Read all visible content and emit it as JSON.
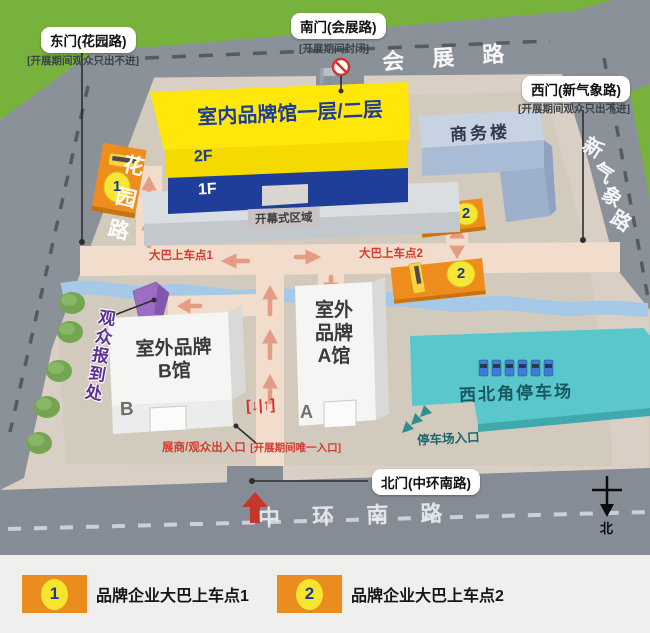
{
  "gates": {
    "east": {
      "label": "东门(花园路)",
      "note": "[开展期间观众只出不进]"
    },
    "south": {
      "label": "南门(会展路)",
      "note": "[开展期间封闭]"
    },
    "west": {
      "label": "西门(新气象路)",
      "note": "[开展期间观众只出不进]"
    },
    "north": {
      "label": "北门(中环南路)"
    }
  },
  "roads": {
    "top": "会 展 路",
    "left": "花园路",
    "right_chars": {
      "c1": "新",
      "c2": "气",
      "c3": "象",
      "c4": "路"
    },
    "bottom": "中 环 南 路"
  },
  "buildings": {
    "indoor_hall": {
      "title": "室内品牌馆一层/二层",
      "floor2": "2F",
      "floor1": "1F",
      "stage": "开幕式区域"
    },
    "business": "商务楼",
    "hall_b": {
      "line1": "室外品牌",
      "line2": "B馆",
      "letter": "B"
    },
    "hall_a": {
      "line1": "室外",
      "line2": "品牌",
      "line3": "A馆",
      "letter": "A"
    },
    "parking": {
      "name": "西北角停车场",
      "entrance": "停车场入口"
    },
    "reception": "观众报到处"
  },
  "paths": {
    "bus_stop1": "大巴上车点1",
    "bus_stop2": "大巴上车点2",
    "exit": "展商/观众出入口",
    "exit_note": "[开展期间唯一入口]",
    "gate_sign": "[↓|↑]"
  },
  "markers": {
    "stop1": "1",
    "stop2": "2"
  },
  "compass": {
    "north": "北"
  },
  "legend": {
    "items": [
      {
        "num": "1",
        "label": "品牌企业大巴上车点1"
      },
      {
        "num": "2",
        "label": "品牌企业大巴上车点2"
      }
    ]
  },
  "colors": {
    "grass": "#77b23d",
    "road": "#8b9199",
    "venue": "#d9cfc4",
    "hall_yellow": "#ffe70a",
    "hall_blue": "#1f3e99",
    "business_blue": "#a9bcd6",
    "parking_teal": "#59c7cc",
    "platform_orange": "#ee8d1d",
    "marker_yellow": "#f6e636",
    "path_salmon": "#f2dccb",
    "arrow_salmon": "#e59c85",
    "label_red": "#d23b30",
    "reception_purple": "#9d6dc4",
    "river_blue": "#a6c9e7"
  }
}
